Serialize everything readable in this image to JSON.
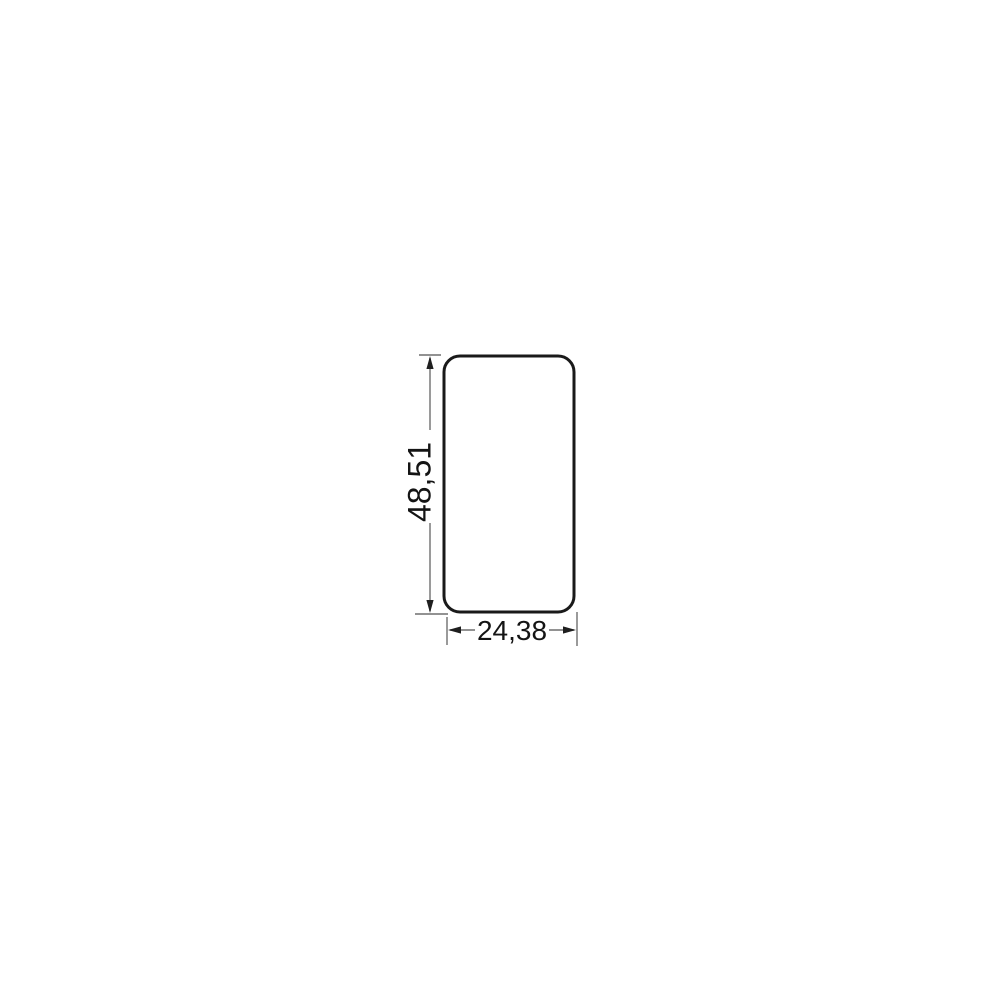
{
  "drawing": {
    "shape": "rounded-rectangle",
    "dimensions": {
      "height": {
        "label": "48,51",
        "value": 48.51
      },
      "width": {
        "label": "24,38",
        "value": 24.38
      }
    },
    "colors": {
      "background": "#ffffff",
      "outline": "#1a1a1a",
      "dimension_line": "#6e6e6e",
      "arrow": "#1f1f1f",
      "text": "#141414"
    }
  }
}
